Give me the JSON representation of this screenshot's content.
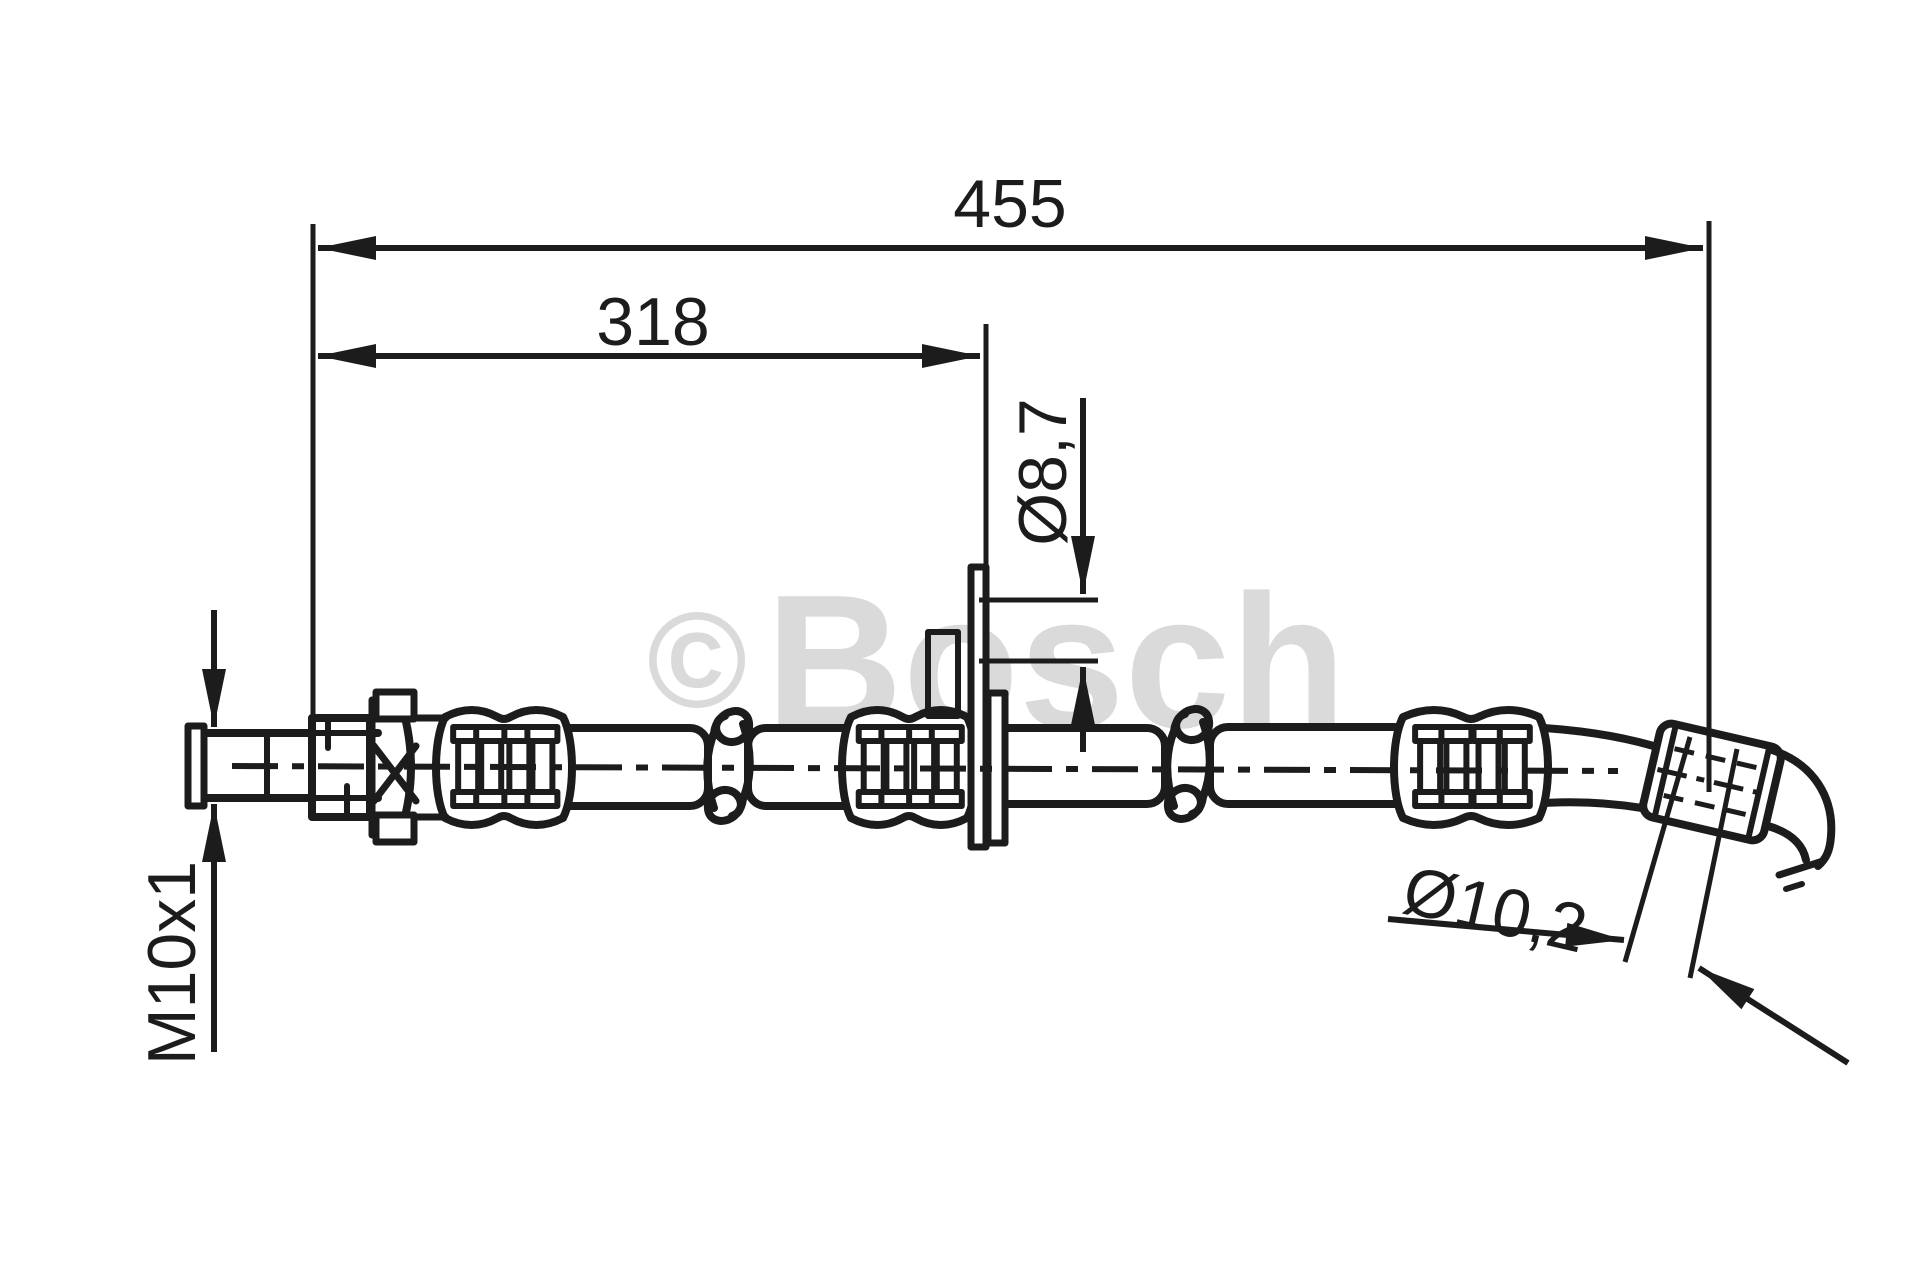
{
  "drawing": {
    "labels": {
      "overall_length": "455",
      "partial_length": "318",
      "port_diameter": "Ø8,7",
      "thread_size": "M10x1",
      "collar_diameter": "Ø10,2"
    },
    "watermark": {
      "copyright_symbol": "©",
      "brand": "Bosch"
    },
    "colors": {
      "background": "#ffffff",
      "line": "#1c1c1c",
      "watermark": "#dadada"
    }
  }
}
